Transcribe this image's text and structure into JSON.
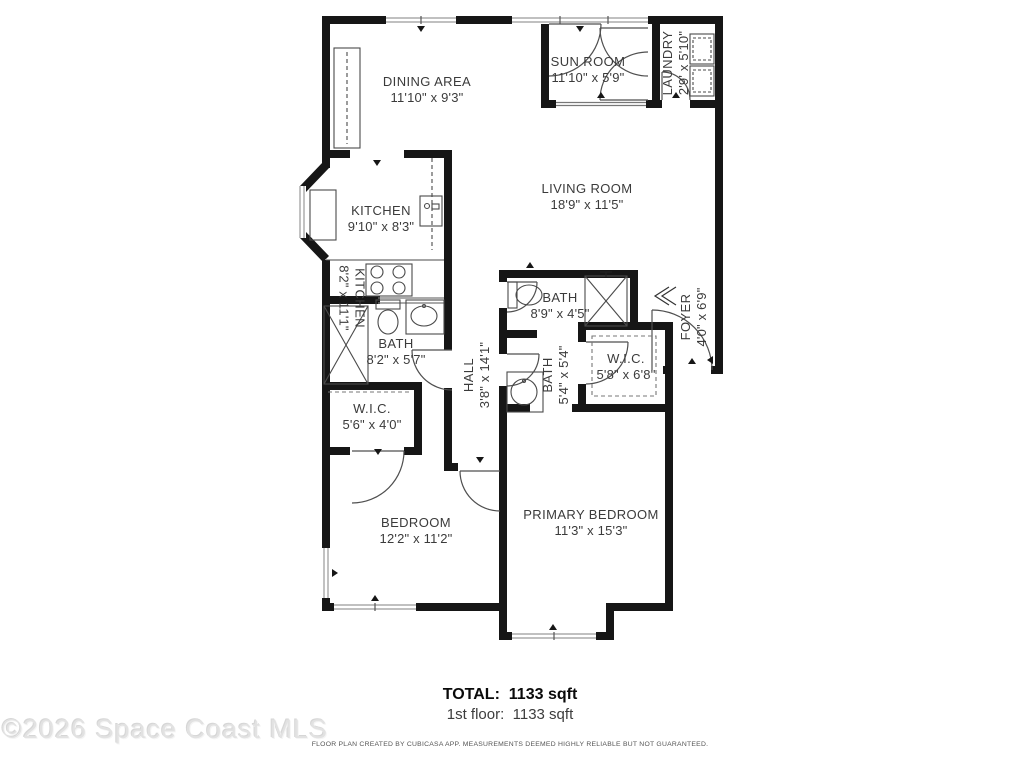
{
  "plan": {
    "rooms": [
      {
        "name": "DINING AREA",
        "dims": "11'10\" x 9'3\""
      },
      {
        "name": "SUN ROOM",
        "dims": "11'10\" x 5'9\""
      },
      {
        "name": "LAUNDRY",
        "dims": "2'9' x 5'10\""
      },
      {
        "name": "LIVING ROOM",
        "dims": "18'9\" x 11'5\""
      },
      {
        "name": "KITCHEN",
        "dims": "9'10\" x 8'3\""
      },
      {
        "name": "KITCHEN",
        "dims": "8'2\" x 11'1\""
      },
      {
        "name": "BATH",
        "dims": "8'9\" x 4'5\""
      },
      {
        "name": "FOYER",
        "dims": "4'0\" x 6'9\""
      },
      {
        "name": "W.I.C.",
        "dims": "5'8\" x 6'8\""
      },
      {
        "name": "BATH",
        "dims": "8'2\" x 5'7\""
      },
      {
        "name": "HALL",
        "dims": "3'8\" x 14'1\""
      },
      {
        "name": "BATH",
        "dims": "5'4\" x 5'4\""
      },
      {
        "name": "W.I.C.",
        "dims": "5'6\" x 4'0\""
      },
      {
        "name": "BEDROOM",
        "dims": "12'2\" x 11'2\""
      },
      {
        "name": "PRIMARY BEDROOM",
        "dims": "11'3\" x 15'3\""
      }
    ],
    "summary": {
      "total_label": "TOTAL:",
      "total_value": "1133 sqft",
      "floor_label": "1st floor:",
      "floor_value": "1133 sqft"
    },
    "disclaimer": "FLOOR PLAN CREATED BY CUBICASA APP. MEASUREMENTS DEEMED HIGHLY RELIABLE BUT NOT GUARANTEED.",
    "watermark": "©2026 Space Coast MLS",
    "colors": {
      "wall": "#161616",
      "label": "#3b3b3b",
      "watermark": "#e2e2e2"
    }
  }
}
